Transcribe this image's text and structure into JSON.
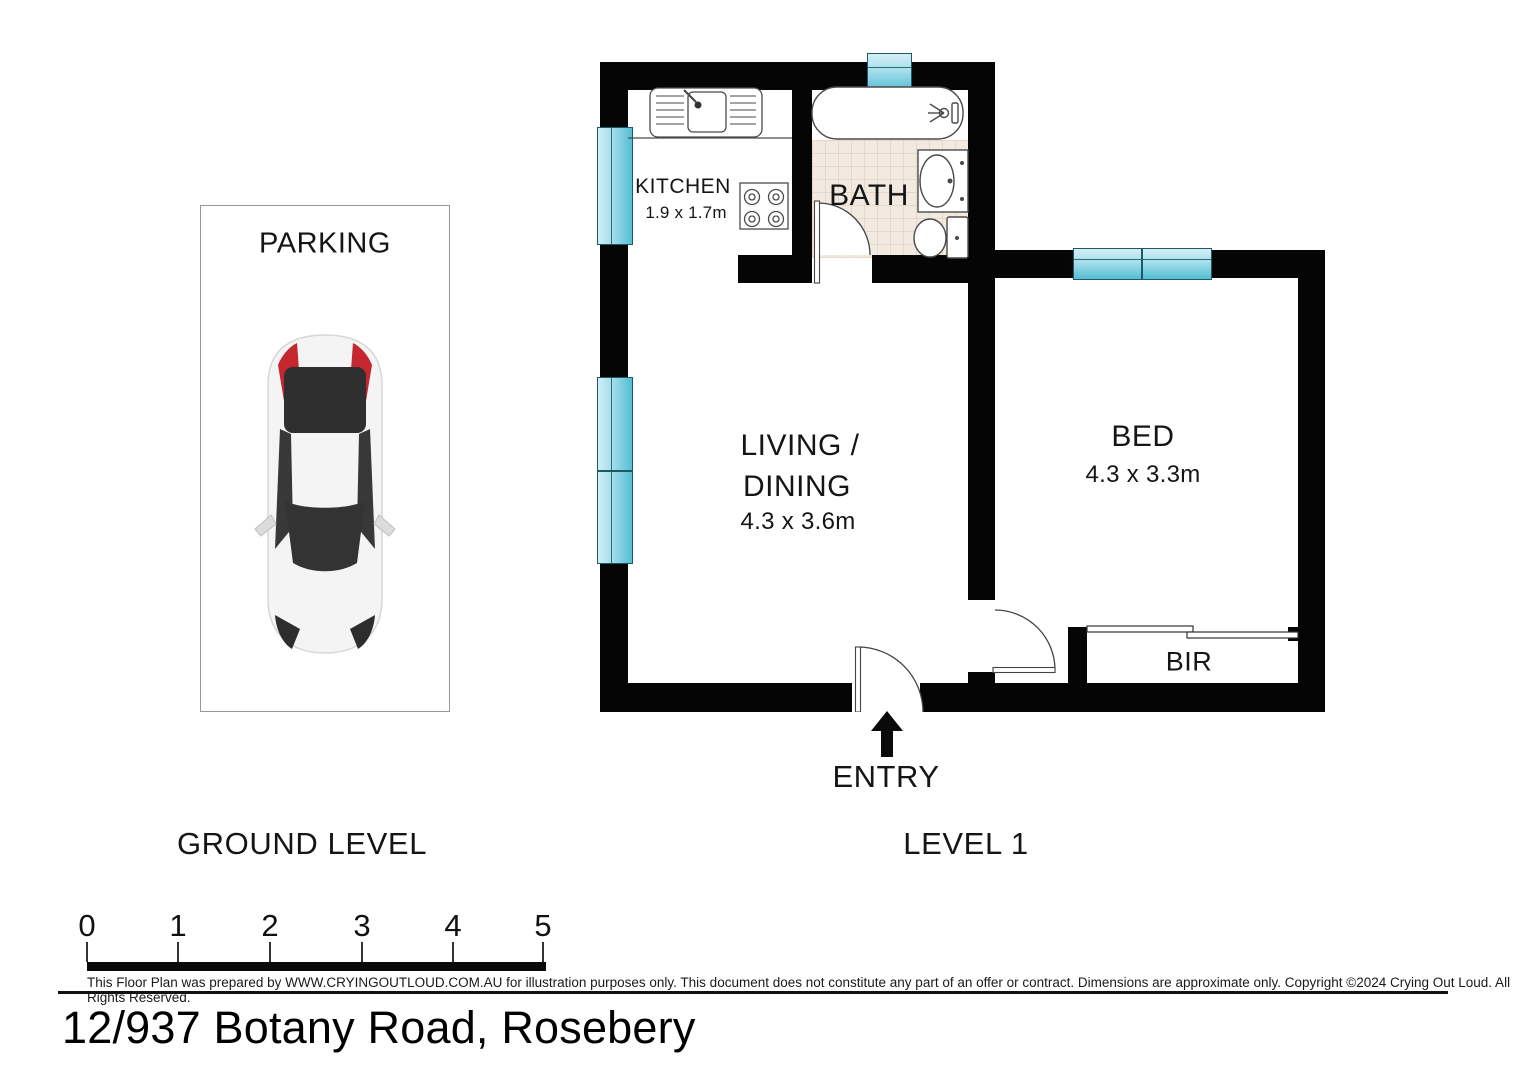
{
  "address": "12/937 Botany Road, Rosebery",
  "disclaimer": "This Floor Plan was prepared by WWW.CRYINGOUTLOUD.COM.AU for illustration purposes only. This document does not constitute any part of an offer or contract. Dimensions are approximate only. Copyright ©2024 Crying Out Loud. All Rights Reserved.",
  "levels": {
    "ground": "GROUND LEVEL",
    "level1": "LEVEL 1"
  },
  "parking": {
    "label": "PARKING"
  },
  "rooms": {
    "kitchen": {
      "name": "KITCHEN",
      "dims": "1.9 x 1.7m"
    },
    "bath": {
      "name": "BATH"
    },
    "living": {
      "name_line1": "LIVING /",
      "name_line2": "DINING",
      "dims": "4.3 x 3.6m"
    },
    "bed": {
      "name": "BED",
      "dims": "4.3 x 3.3m"
    },
    "bir": {
      "name": "BIR"
    }
  },
  "entry": {
    "label": "ENTRY"
  },
  "scale_bar": {
    "unit_labels": [
      "0",
      "1",
      "2",
      "3",
      "4",
      "5"
    ]
  },
  "colors": {
    "wall": "#050505",
    "window_light": "#d3eef5",
    "window_dark": "#55bdd3",
    "tile_floor": "#f2e9e0",
    "car_accent_red": "#c5272e"
  }
}
